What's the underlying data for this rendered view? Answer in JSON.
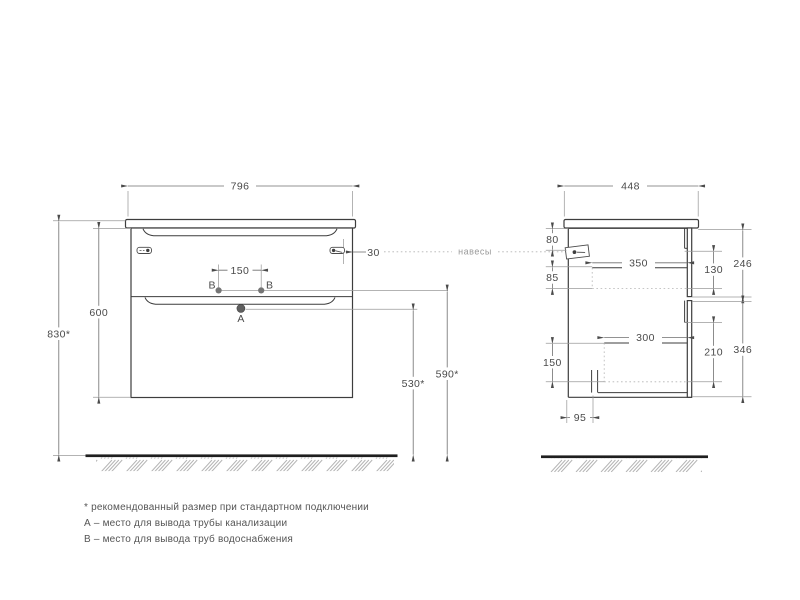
{
  "front": {
    "width": "796",
    "cabinet_height": "600",
    "total_height": "830*",
    "hole_spacing": "150",
    "bracket_offset": "30",
    "drain_height": "530*",
    "supply_height": "590*",
    "label_a": "A",
    "label_b": "B"
  },
  "side": {
    "depth": "448",
    "hanger_top": "80",
    "hanger_gap": "85",
    "drawer1_depth": "350",
    "drawer1_inner": "130",
    "drawer1_front": "246",
    "drawer2_depth": "300",
    "drawer2_inner": "210",
    "drawer2_front": "346",
    "bottom_section": "150",
    "pipe_offset": "95"
  },
  "annotations": {
    "hangers": "навесы"
  },
  "notes": {
    "recommended": "* рекомендованный размер при стандартном подключении",
    "point_a": "А – место для вывода трубы канализации",
    "point_b": "B – место для вывода труб водоснабжения"
  },
  "colors": {
    "line": "#3d3d3d",
    "dim": "#6f6f6f",
    "floor": "#1f1f1f",
    "hatch": "#b5b5b5"
  }
}
